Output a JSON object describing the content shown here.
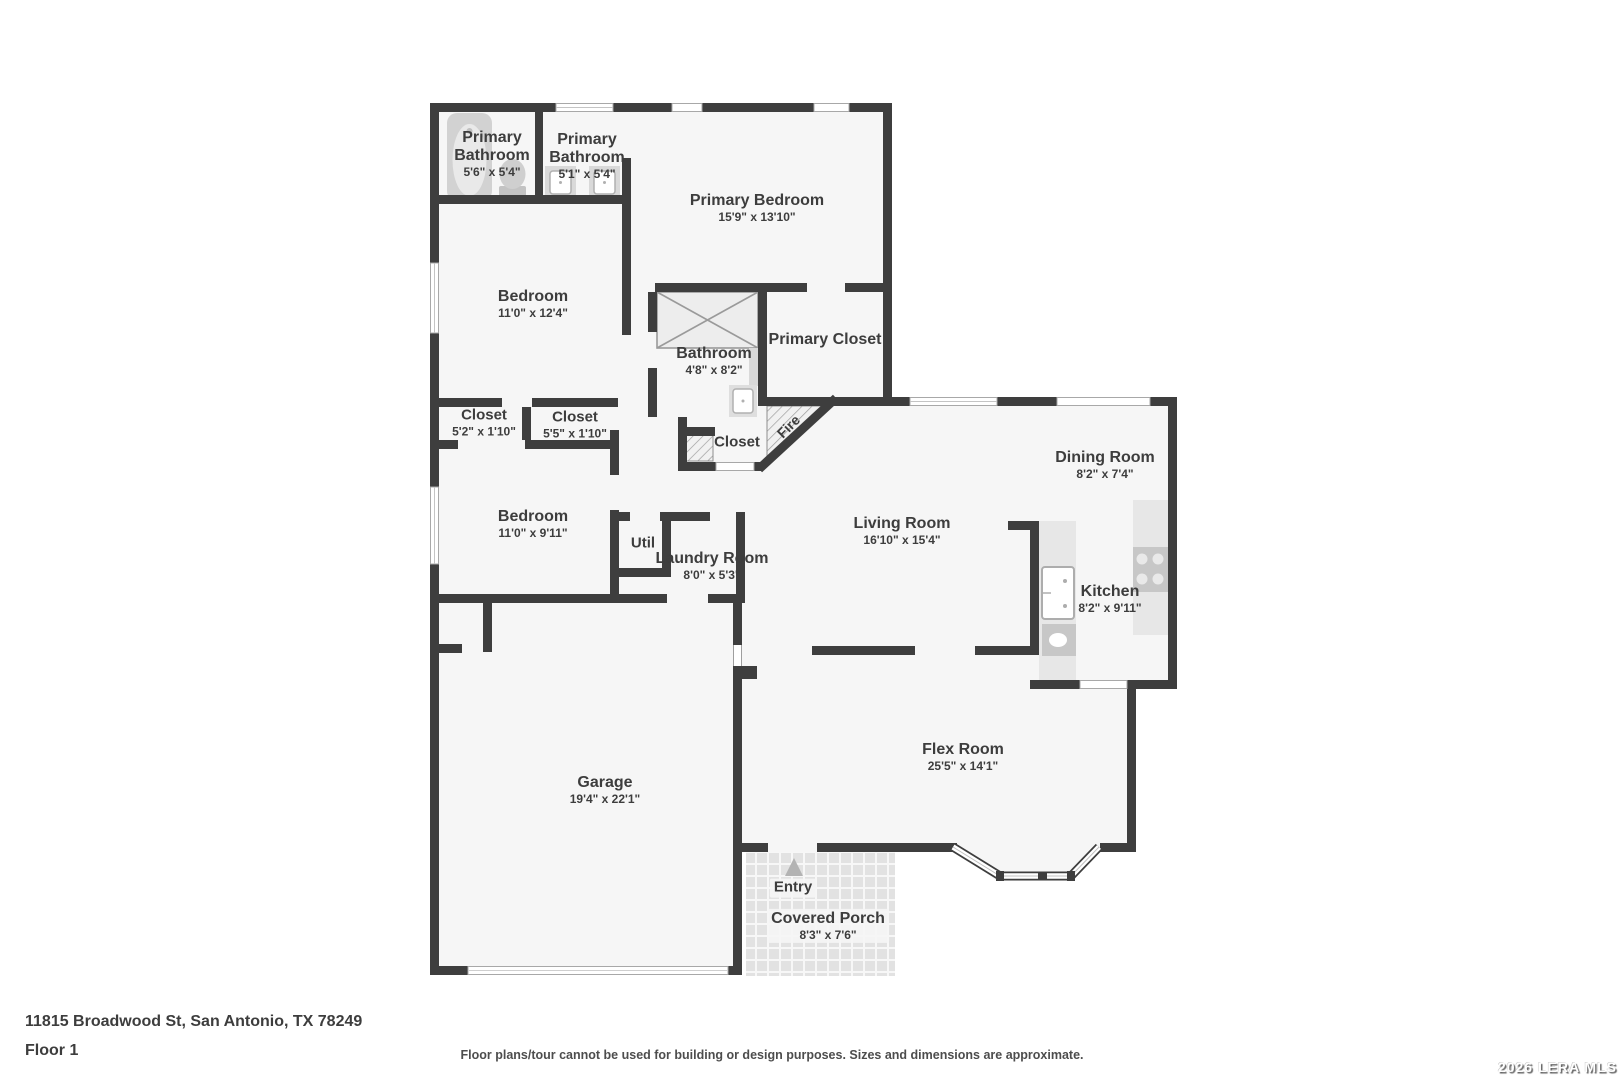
{
  "floorplan": {
    "rooms": {
      "primary_bathroom_1": {
        "name": "Primary Bathroom",
        "dims": "5'6\" x 5'4\""
      },
      "primary_bathroom_2": {
        "name": "Primary Bathroom",
        "dims": "5'1\" x 5'4\""
      },
      "primary_bedroom": {
        "name": "Primary Bedroom",
        "dims": "15'9\" x 13'10\""
      },
      "bedroom_1": {
        "name": "Bedroom",
        "dims": "11'0\" x 12'4\""
      },
      "bathroom": {
        "name": "Bathroom",
        "dims": "4'8\" x 8'2\""
      },
      "primary_closet": {
        "name": "Primary Closet",
        "dims": ""
      },
      "closet_1": {
        "name": "Closet",
        "dims": "5'2\" x 1'10\""
      },
      "closet_2": {
        "name": "Closet",
        "dims": "5'5\" x 1'10\""
      },
      "closet_small": {
        "name": "Closet",
        "dims": ""
      },
      "fireplace": {
        "name": "Fire",
        "dims": ""
      },
      "bedroom_2": {
        "name": "Bedroom",
        "dims": "11'0\" x 9'11\""
      },
      "util": {
        "name": "Util",
        "dims": ""
      },
      "laundry": {
        "name": "Laundry Room",
        "dims": "8'0\" x 5'3\""
      },
      "dining": {
        "name": "Dining Room",
        "dims": "8'2\" x 7'4\""
      },
      "living": {
        "name": "Living Room",
        "dims": "16'10\" x 15'4\""
      },
      "kitchen": {
        "name": "Kitchen",
        "dims": "8'2\" x 9'11\""
      },
      "garage": {
        "name": "Garage",
        "dims": "19'4\" x 22'1\""
      },
      "flex": {
        "name": "Flex Room",
        "dims": "25'5\" x 14'1\""
      },
      "entry": {
        "name": "Entry",
        "dims": ""
      },
      "porch": {
        "name": "Covered Porch",
        "dims": "8'3\" x 7'6\""
      }
    },
    "colors": {
      "wall": "#3e3e3e",
      "floor": "#f6f6f6",
      "fixture": "#d6d6d6",
      "text": "#3d3d3d"
    }
  },
  "footer": {
    "address": "11815 Broadwood St, San Antonio, TX 78249",
    "floor_label": "Floor 1",
    "disclaimer": "Floor plans/tour cannot be used for building or design purposes. Sizes and dimensions are approximate.",
    "watermark": "2026 LERA MLS"
  }
}
